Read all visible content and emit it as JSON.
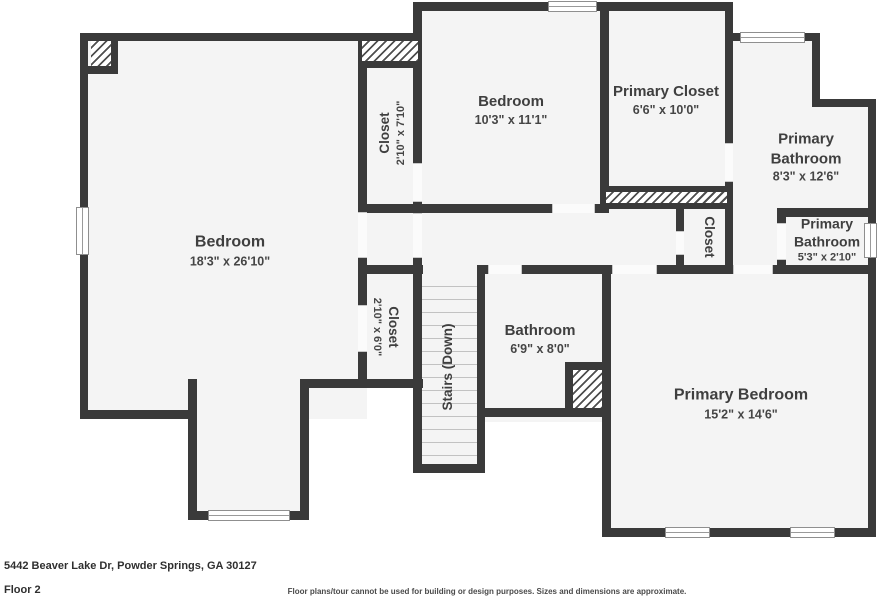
{
  "footer": {
    "address": "5442 Beaver Lake Dr, Powder Springs, GA 30127",
    "floor_label": "Floor 2",
    "disclaimer": "Floor plans/tour cannot be used for building or design purposes. Sizes and dimensions are approximate."
  },
  "colors": {
    "wall": "#3a3a3a",
    "room_fill": "#f4f4f4",
    "label_text": "#3f3f3f"
  },
  "rooms": [
    {
      "name": "Bedroom",
      "dimensions": "18'3\" x 26'10\""
    },
    {
      "name": "Closet",
      "dimensions": "2'10\" x 7'10\""
    },
    {
      "name": "Bedroom",
      "dimensions": "10'3\" x 11'1\""
    },
    {
      "name": "Primary Closet",
      "dimensions": "6'6\" x 10'0\""
    },
    {
      "name": "Primary Bathroom",
      "dimensions": "8'3\" x 12'6\""
    },
    {
      "name": "Closet",
      "dimensions": ""
    },
    {
      "name": "Primary Bathroom",
      "dimensions": "5'3\" x 2'10\""
    },
    {
      "name": "Closet",
      "dimensions": "2'10\" x 6'0\""
    },
    {
      "name": "Stairs (Down)",
      "dimensions": ""
    },
    {
      "name": "Bathroom",
      "dimensions": "6'9\" x 8'0\""
    },
    {
      "name": "Primary Bedroom",
      "dimensions": "15'2\" x 14'6\""
    }
  ]
}
